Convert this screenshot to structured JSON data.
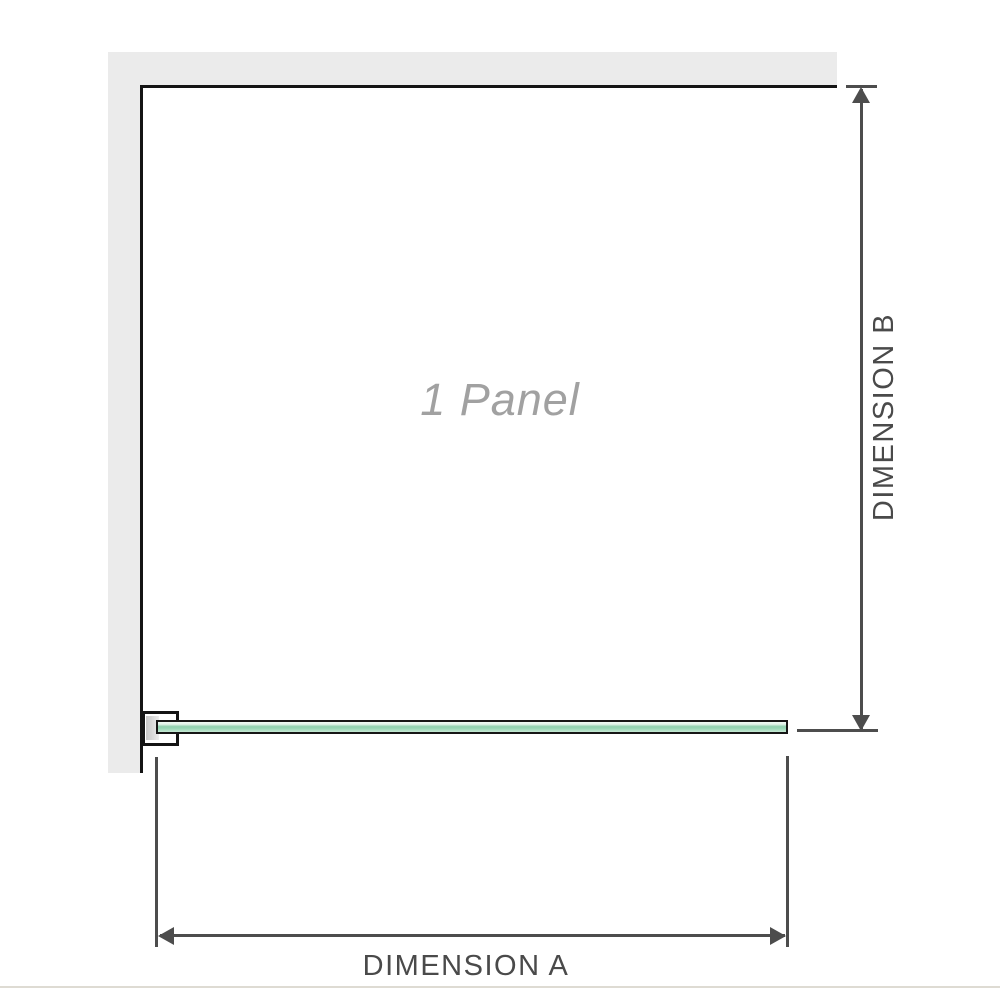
{
  "diagram": {
    "panel_label": "1 Panel",
    "dimension_a": {
      "label": "DIMENSION A"
    },
    "dimension_b": {
      "label": "DIMENSION B"
    },
    "colors": {
      "wall_fill": "#ebebeb",
      "wall_edge_line": "#141414",
      "dimension_line": "#4d4d4d",
      "dimension_text": "#4a4a4a",
      "panel_label_text": "#a1a1a1",
      "glass_border": "#161616",
      "glass_green": "#8fd0ae",
      "glass_highlight": "#f0f9f4",
      "bracket_fill": "#ffffff",
      "bracket_shadow": "#c6c6c6",
      "bottom_rule": "#dedbd3"
    }
  }
}
